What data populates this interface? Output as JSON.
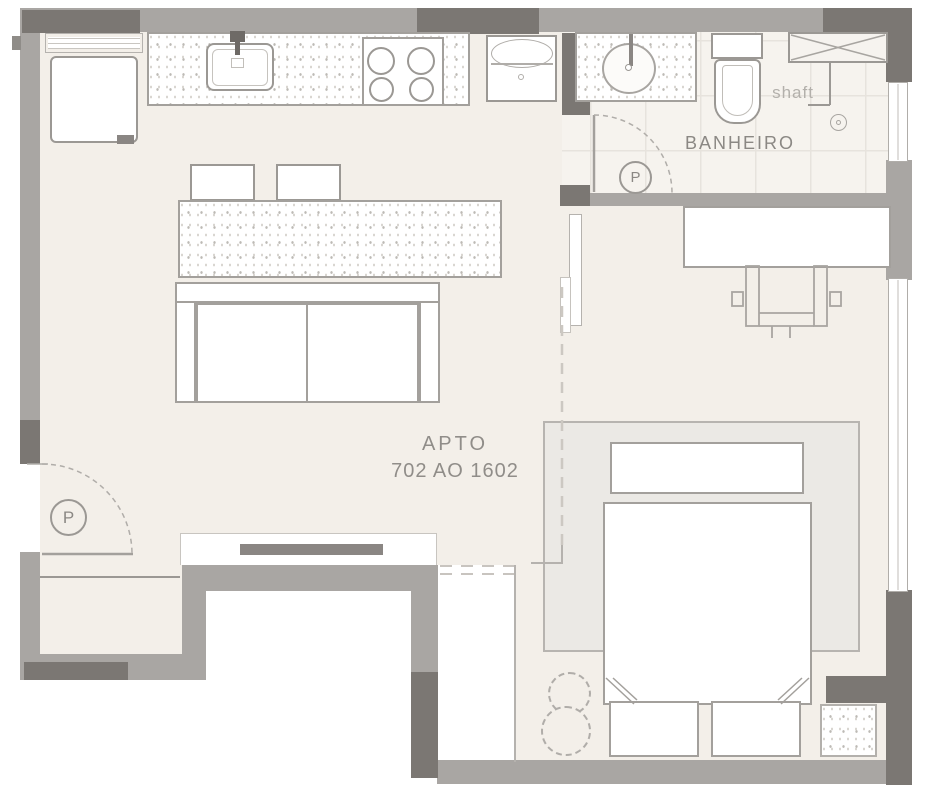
{
  "title": "apartment-floor-plan",
  "labels": {
    "apartment_line1": "APTO",
    "apartment_line2": "702 AO 1602",
    "bathroom": "BANHEIRO",
    "shaft": "shaft",
    "door_marker": "P"
  },
  "colors": {
    "wall_light": "#a9a6a3",
    "wall_dark": "#7b7773",
    "floor": "#f3efe9",
    "tile_floor": "#f6f3ee",
    "tile_line": "#e7e3dd",
    "rug": "#ebe9e5",
    "furniture_line": "#a3a09c",
    "label_text": "#8b8884",
    "shaft_text": "#b3b0ab",
    "dashed_line": "#ccc8c2"
  }
}
